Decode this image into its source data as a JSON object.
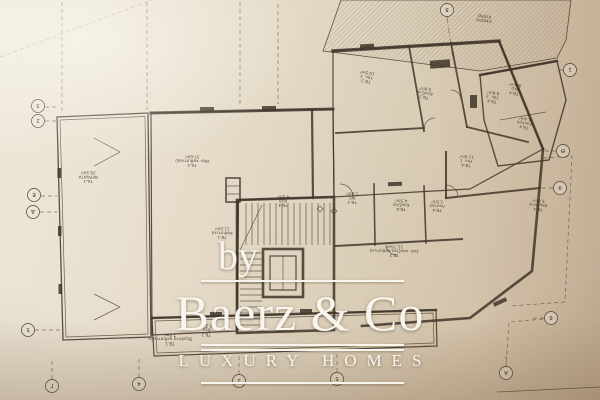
{
  "watermark": {
    "prefix": "by",
    "brand": "Baerz & Co",
    "tagline": "LUXURY HOMES"
  },
  "plan": {
    "adjacent_building": "ΟΜΟΡΟ ΚΤΙΡΙΟ",
    "room_labels": [
      {
        "code": "ΟΜΟΡΟ",
        "name": "ΚΤΙΡΙΟ",
        "area": "",
        "x": 484,
        "y": 19,
        "rot": 188
      },
      {
        "code": "ΤΔ.1",
        "name": "ΒΕΡΑΝΤΑ",
        "area": "28.5m²",
        "x": 88,
        "y": 180,
        "rot": 181
      },
      {
        "code": "ΤΔ.1",
        "name": "Βερ. καθιστικού",
        "area": "37.0m²",
        "x": 192,
        "y": 164,
        "rot": 181
      },
      {
        "code": "ΤΒ.3",
        "name": "Υπν. 2",
        "area": "10.5m²",
        "x": 366,
        "y": 80,
        "rot": 189
      },
      {
        "code": "ΤΒ.3",
        "name": "Κουζίνα",
        "area": "5.6m²",
        "x": 424,
        "y": 96,
        "rot": 189
      },
      {
        "code": "ΤΒ.4",
        "name": "Υπν. 3",
        "area": "9.8m²",
        "x": 492,
        "y": 100,
        "rot": 189
      },
      {
        "code": "ΤΒ.4",
        "name": "Λουτρό",
        "area": "4.4m²",
        "x": 524,
        "y": 126,
        "rot": 189
      },
      {
        "code": "ΤΒ.4",
        "name": "Βερ.",
        "area": "9.6m²",
        "x": 514,
        "y": 92,
        "rot": 189
      },
      {
        "code": "ΤΒ.4",
        "name": "ΧΩΛ",
        "area": "4.0m²",
        "x": 283,
        "y": 204,
        "rot": 181
      },
      {
        "code": "ΤΒ.1",
        "name": "WC",
        "area": "1.8m²",
        "x": 352,
        "y": 201,
        "rot": 181
      },
      {
        "code": "ΤΒ.4",
        "name": "Κουζίνα",
        "area": "4.5m²",
        "x": 401,
        "y": 208,
        "rot": 181
      },
      {
        "code": "ΤΒ.4",
        "name": "Λουτρό",
        "area": "3.5m²",
        "x": 437,
        "y": 209,
        "rot": 182
      },
      {
        "code": "ΤΒ.4",
        "name": "Υπν. 1",
        "area": "11.0m²",
        "x": 466,
        "y": 164,
        "rot": 184
      },
      {
        "code": "ΤΒ.2",
        "name": "Σαλ. κουζίνα-καθιστικό",
        "area": "21.75m²",
        "x": 394,
        "y": 254,
        "rot": 181
      },
      {
        "code": "ΤΒ.4",
        "name": "Βεράντα",
        "area": "5.8m²",
        "x": 538,
        "y": 208,
        "rot": 184
      },
      {
        "code": "ΤΒ.1",
        "name": "Καθιστικό",
        "area": "12.0m²",
        "x": 222,
        "y": 236,
        "rot": 181
      },
      {
        "code": "ΤΒ.1",
        "name": "Βεράντα καθιστικών",
        "area": "7.0m²",
        "x": 170,
        "y": 342,
        "rot": 180
      },
      {
        "code": "ΤΒ.2",
        "name": "Βερ.",
        "area": "5.2m²",
        "x": 206,
        "y": 333,
        "rot": 180
      }
    ],
    "grid_bubbles": [
      {
        "x": 38,
        "y": 106,
        "c": "3"
      },
      {
        "x": 38,
        "y": 121,
        "c": "2"
      },
      {
        "x": 34,
        "y": 195,
        "c": "Ε"
      },
      {
        "x": 33,
        "y": 212,
        "c": "Δ"
      },
      {
        "x": 28,
        "y": 330,
        "c": "5"
      },
      {
        "x": 52,
        "y": 386,
        "c": "Γ"
      },
      {
        "x": 139,
        "y": 384,
        "c": "4"
      },
      {
        "x": 239,
        "y": 381,
        "c": "2"
      },
      {
        "x": 337,
        "y": 379,
        "c": "5"
      },
      {
        "x": 570,
        "y": 70,
        "c": "1"
      },
      {
        "x": 563,
        "y": 151,
        "c": "Θ"
      },
      {
        "x": 560,
        "y": 188,
        "c": "9"
      },
      {
        "x": 551,
        "y": 318,
        "c": "6"
      },
      {
        "x": 506,
        "y": 373,
        "c": "Α"
      },
      {
        "x": 447,
        "y": 10,
        "c": "8"
      }
    ],
    "colors": {
      "paper_light": "#efe9db",
      "paper_dark": "#c6b29a",
      "ink": "#3f352a",
      "hatch": "#7b6a53",
      "watermark": "#f8f5ef"
    }
  }
}
